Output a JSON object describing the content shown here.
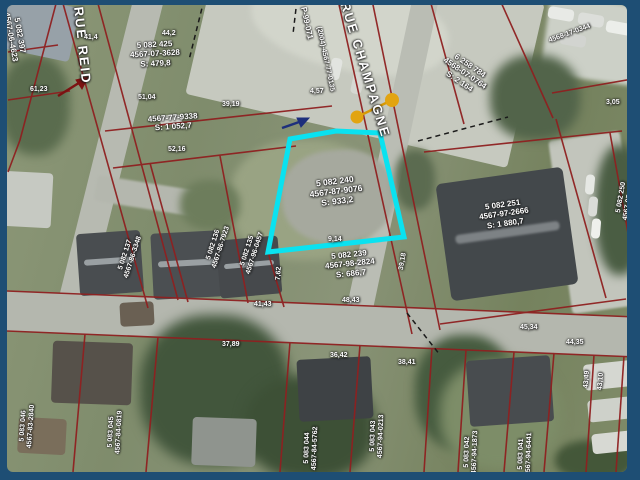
{
  "colors": {
    "frame_border": "#1e4e74",
    "cadastre_line": "#8f2020",
    "highlight": "#0ae2f0",
    "marker_orange": "#e2a411",
    "dashed_line": "#1a1a1a"
  },
  "streets": {
    "reid": "RUE REID",
    "champagne": "RUE CHAMPAGNE"
  },
  "subject_lot": {
    "l1": "5 082 240",
    "l2": "4567-87-9076",
    "l3": "S: 933,2",
    "highlight_color": "#0ae2f0"
  },
  "lots": {
    "top_left": {
      "l1": "5 082 397",
      "l2": "4567-06-4623"
    },
    "reid_top": {
      "l1": "5 082 425",
      "l2": "4567-07-3628",
      "l3": "S: 479,8"
    },
    "mid": {
      "l1": "4567-77-9338",
      "l2": "S: 1 052,7"
    },
    "p99": {
      "l1": "P-99-071"
    },
    "champ_west": {
      "l1": "(2004)-4567-77-0135"
    },
    "top_right": {
      "l1": "6 258 784",
      "l2": "4568-07-0764",
      "l3": "S: 2 164"
    },
    "far_top_right": {
      "l1": "4568-17-0344"
    },
    "building": {
      "l1": "5 082 251",
      "l2": "4567-97-2666",
      "l3": "S: 1 880,7"
    },
    "below_subject": {
      "l1": "5 082 239",
      "l2": "4567-98-2824",
      "l3": "S: 686,7"
    },
    "house_a": {
      "l1": "5 082 137",
      "l2": "4567-86-3348"
    },
    "house_b": {
      "l1": "5 082 136",
      "l2": "4567-86-7923"
    },
    "house_c": {
      "l1": "5 082 135",
      "l2": "4567-96-0457"
    },
    "bottom_a": {
      "l1": "5 083 046",
      "l2": "4567-83-2840"
    },
    "bottom_b": {
      "l1": "5 083 045",
      "l2": "4567-84-0819"
    },
    "bottom_c": {
      "l1": "5 083 044",
      "l2": "4567-84-5762"
    },
    "bottom_d": {
      "l1": "5 083 043",
      "l2": "4567-94-0213"
    },
    "bottom_e": {
      "l1": "5 083 042",
      "l2": "4567-94-1873"
    },
    "bottom_f": {
      "l1": "5 083 041",
      "l2": "4567-94-6441"
    },
    "right_mid": {
      "l1": "5 082 250",
      "l2": "4567-97-8468"
    }
  },
  "measurements": {
    "m0": "41,4",
    "m1": "44,2",
    "m2": "61,23",
    "m3": "51,04",
    "m4": "39,19",
    "m5": "52,16",
    "m6": "3,05",
    "m7": "9,14",
    "m8": "48,43",
    "m9": "7,62",
    "m10": "39,18",
    "m11": "41,43",
    "m12": "37,89",
    "m13": "36,42",
    "m14": "38,41",
    "m15": "45,34",
    "m16": "44,35",
    "m17": "43,49",
    "m18": "43,10",
    "m19": "4,57"
  }
}
